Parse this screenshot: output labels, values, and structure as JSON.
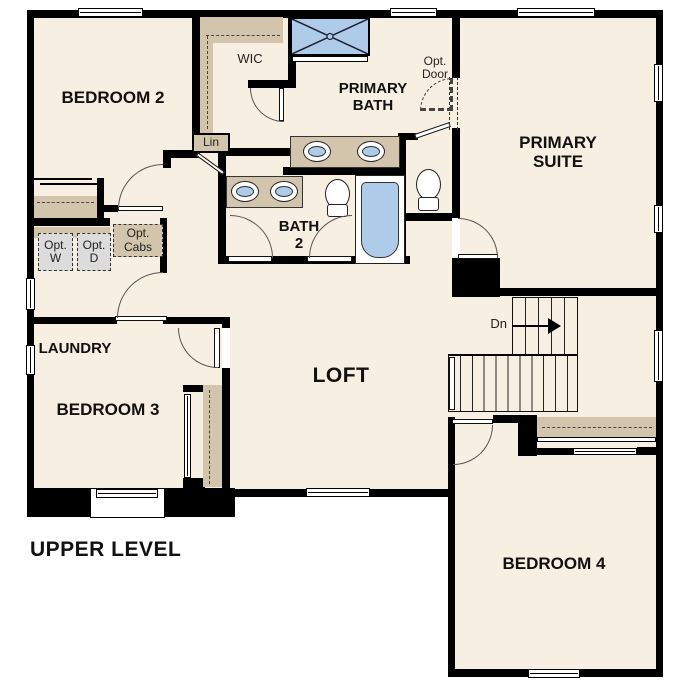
{
  "plan_title": "UPPER LEVEL",
  "rooms": {
    "bedroom2": {
      "label": "BEDROOM 2"
    },
    "wic": {
      "label": "WIC"
    },
    "primary_bath": {
      "line1": "PRIMARY",
      "line2": "BATH"
    },
    "primary_suite": {
      "line1": "PRIMARY",
      "line2": "SUITE"
    },
    "bath2": {
      "line1": "BATH",
      "line2": "2"
    },
    "laundry": {
      "label": "LAUNDRY"
    },
    "loft": {
      "label": "LOFT"
    },
    "bedroom3": {
      "label": "BEDROOM 3"
    },
    "bedroom4": {
      "label": "BEDROOM 4"
    }
  },
  "annotations": {
    "linen": "Lin",
    "opt_door": {
      "line1": "Opt.",
      "line2": "Door"
    },
    "opt_washer": {
      "line1": "Opt.",
      "line2": "W"
    },
    "opt_dryer": {
      "line1": "Opt.",
      "line2": "D"
    },
    "opt_cabinets": {
      "line1": "Opt.",
      "line2": "Cabs"
    },
    "stair_direction": "Dn"
  },
  "colors": {
    "wall": "#000000",
    "floor": "#f7efe2",
    "cabinet_tan": "#d3c5ab",
    "fixture_blue": "#aecbe9",
    "appliance_gray": "#dcdcdc"
  }
}
